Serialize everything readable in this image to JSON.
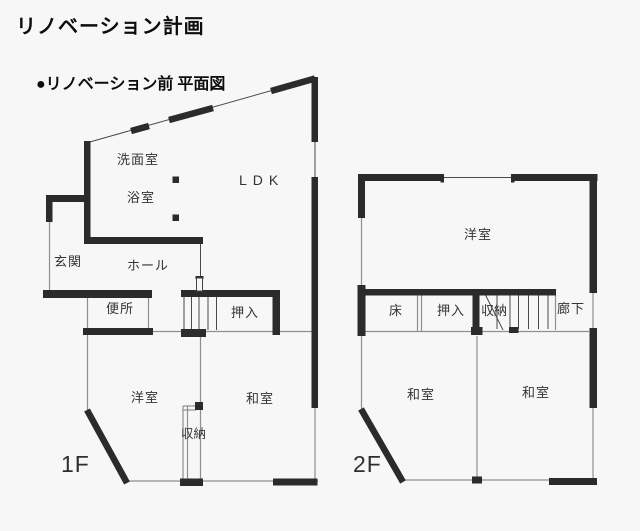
{
  "page": {
    "title": "リノベーション計画",
    "section_heading": "●リノベーション前 平面図"
  },
  "colors": {
    "wall": "#2b2b2b",
    "thin_line": "#8f8f8f",
    "background": "#f7f7f7",
    "text": "#333333"
  },
  "floor1": {
    "floor_label": "1F",
    "rooms": {
      "washroom": "洗面室",
      "bathroom": "浴室",
      "ldk": "LDK",
      "entrance": "玄関",
      "hall": "ホール",
      "toilet": "便所",
      "futon_closet": "押入",
      "western_room": "洋室",
      "japanese_room": "和室",
      "storage": "収納"
    }
  },
  "floor2": {
    "floor_label": "2F",
    "rooms": {
      "western_room": "洋室",
      "alcove": "床",
      "futon_closet": "押入",
      "storage": "収納",
      "corridor": "廊下",
      "japanese_room_left": "和室",
      "japanese_room_right": "和室"
    }
  }
}
